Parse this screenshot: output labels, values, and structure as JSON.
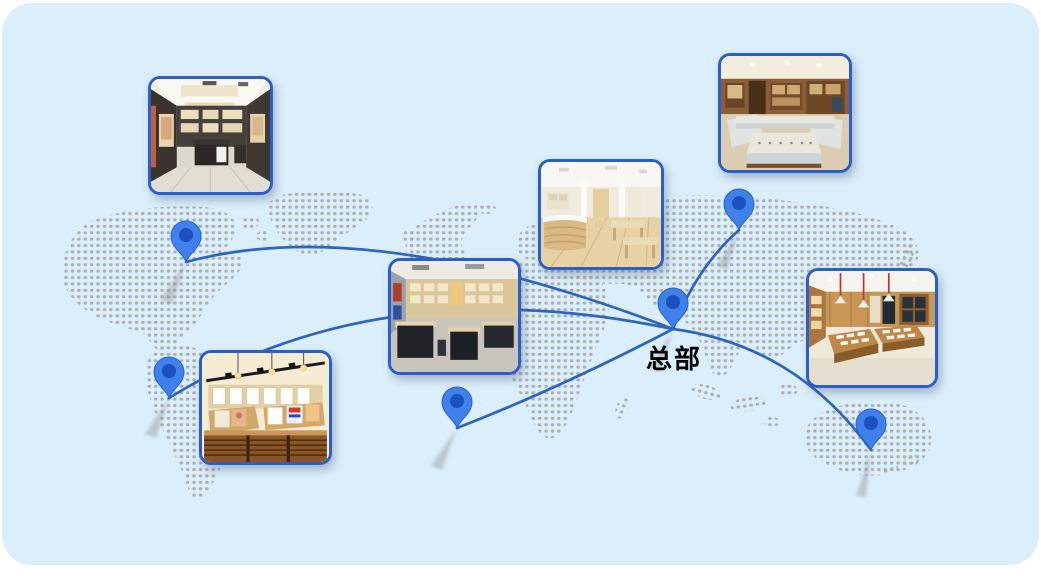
{
  "panel": {
    "page_background": "#ffffff",
    "background": "#daeefb",
    "corner_radius_px": 30
  },
  "map": {
    "dot_color": "#a7a29d",
    "regions": [
      "north-america",
      "greenland",
      "arctic-islands",
      "iceland",
      "british-isles",
      "south-america",
      "europe",
      "africa",
      "madagascar",
      "asia",
      "southeast-asia",
      "japan",
      "australia",
      "new-zealand"
    ]
  },
  "network": {
    "line_color": "#2e65bd",
    "pin_color": "#3f80ea",
    "pin_inner_color": "#1d50c0",
    "hub": {
      "label": "总部",
      "text_color": "#000000"
    },
    "pins": [
      {
        "id": "pin-north-america"
      },
      {
        "id": "pin-south-america"
      },
      {
        "id": "pin-west-africa"
      },
      {
        "id": "pin-headquarters"
      },
      {
        "id": "pin-northeast-asia"
      },
      {
        "id": "pin-australia"
      }
    ]
  },
  "photos": [
    {
      "id": "store-photo-top-left",
      "subject": "optical-store-dark-cabinets"
    },
    {
      "id": "store-photo-center",
      "subject": "bright-optical-showroom"
    },
    {
      "id": "store-photo-top-right",
      "subject": "jewelry-counter-store"
    },
    {
      "id": "store-photo-middle",
      "subject": "dark-counter-eyewear-store"
    },
    {
      "id": "store-photo-bottom-left",
      "subject": "wood-shelf-poster-store"
    },
    {
      "id": "store-photo-right",
      "subject": "wood-display-store-red-lamps"
    }
  ]
}
